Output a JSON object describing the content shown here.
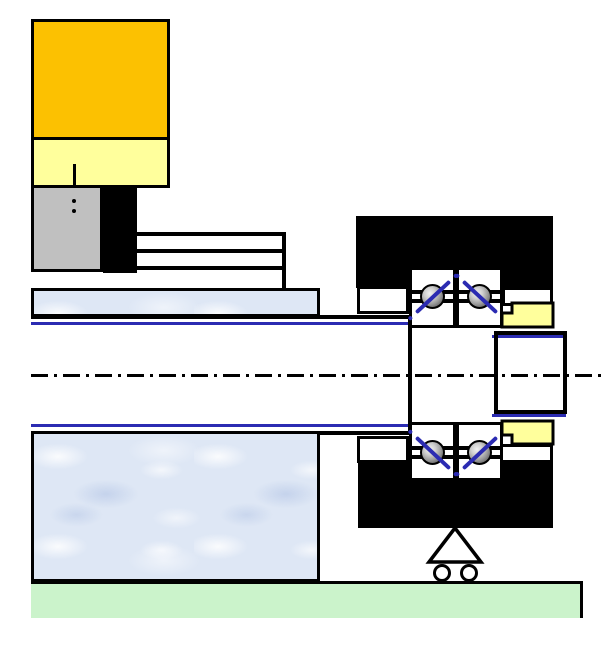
{
  "diagram": {
    "kind": "mechanical engineering drawing",
    "subject": "machine spindle shaft supported by a duplex angular-contact ball bearing unit on a machine bed",
    "text_labels": [],
    "symbols": [
      {
        "id": "roller-support-symbol",
        "meaning": "movable roller support under bearing housing"
      },
      {
        "id": "center-axis-line",
        "meaning": "horizontal dash-dot rotation axis of shaft"
      },
      {
        "id": "tool-axis-line",
        "meaning": "short vertical dash-dot axis through upper blocks"
      },
      {
        "id": "contact-angle-lines",
        "meaning": "blue diagonal lines through bearing balls, O-arrangement"
      }
    ]
  },
  "components": [
    {
      "id": "motor-body-block",
      "label": "Gold block (drive unit body)",
      "color": "#fcc101"
    },
    {
      "id": "motor-flange-block",
      "label": "Pale yellow flange block",
      "color": "#ffff9c"
    },
    {
      "id": "gray-block",
      "label": "Gray block",
      "color": "#c0c0c0"
    },
    {
      "id": "black-column-block",
      "label": "Black column block",
      "color": "#000000"
    },
    {
      "id": "spacer-plates",
      "label": "Stacked spacer plates",
      "color": "#ffffff"
    },
    {
      "id": "housing-upper-wall",
      "label": "Upper housing wall (marble texture)",
      "color": "#dee7f5"
    },
    {
      "id": "headstock-casting",
      "label": "Headstock casting (marble texture)",
      "color": "#dee7f5"
    },
    {
      "id": "spindle-shaft",
      "label": "Spindle shaft (blue outline)",
      "color": "#2b2bb2"
    },
    {
      "id": "bearing-housing-top",
      "label": "Bearing housing, upper half (black)",
      "color": "#000000"
    },
    {
      "id": "bearing-housing-bottom",
      "label": "Bearing housing, lower half (black)",
      "color": "#000000"
    },
    {
      "id": "bearing-balls",
      "label": "Angular contact bearing balls",
      "color": "#9a9a9a"
    },
    {
      "id": "locknut-top",
      "label": "Shaft locknut, upper section (yellow)",
      "color": "#ffff9c"
    },
    {
      "id": "locknut-bottom",
      "label": "Shaft locknut, lower section (yellow)",
      "color": "#ffff9c"
    },
    {
      "id": "roller-support-symbol",
      "label": "Roller support symbol (triangle on wheels)",
      "color": "#000000"
    },
    {
      "id": "machine-bed",
      "label": "Machine bed (green)",
      "color": "#cbf3cb"
    }
  ],
  "colors": {
    "ink": "#000000",
    "paper": "#ffffff",
    "gold": "#fcc101",
    "cream": "#ffff9c",
    "gray": "#c0c0c0",
    "marble-base": "#dee7f5",
    "marble-vein": "#b9cbe8",
    "green": "#cbf3cb",
    "blue-line": "#2b2bb2",
    "ball-light": "#f2f2f2",
    "ball-dark": "#555555"
  }
}
